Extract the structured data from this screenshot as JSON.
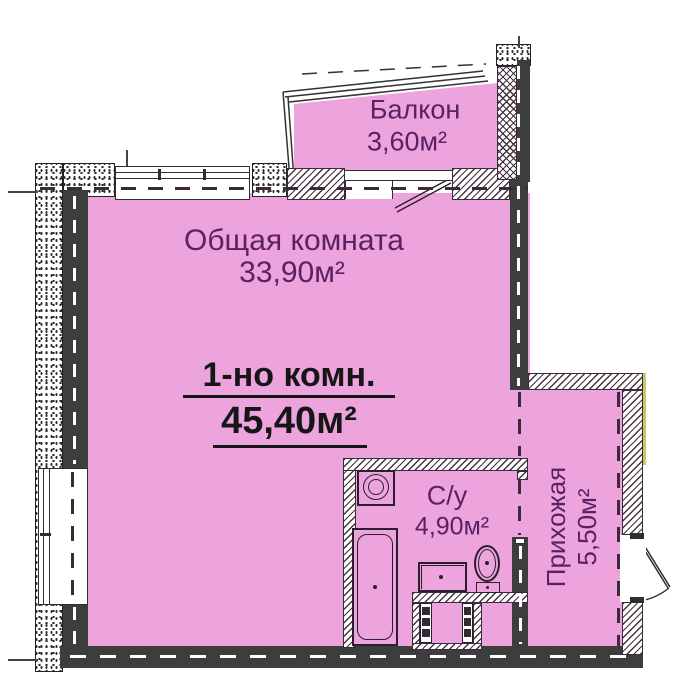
{
  "plan": {
    "balcony": {
      "label": "Балкон",
      "area": "3,60м²"
    },
    "living": {
      "label": "Общая комната",
      "area": "33,90м²"
    },
    "summary": {
      "title": "1-но комн.",
      "area": "45,40м²"
    },
    "bathroom": {
      "label": "С/у",
      "area": "4,90м²"
    },
    "hallway": {
      "label": "Прихожая",
      "area": "5,50м²"
    }
  },
  "colors": {
    "room_fill": "#eda3dc",
    "wall_dark": "#3d3d3d",
    "label_purple": "#5b2162",
    "label_black": "#161616",
    "outer_accent": "#c3cc62"
  }
}
